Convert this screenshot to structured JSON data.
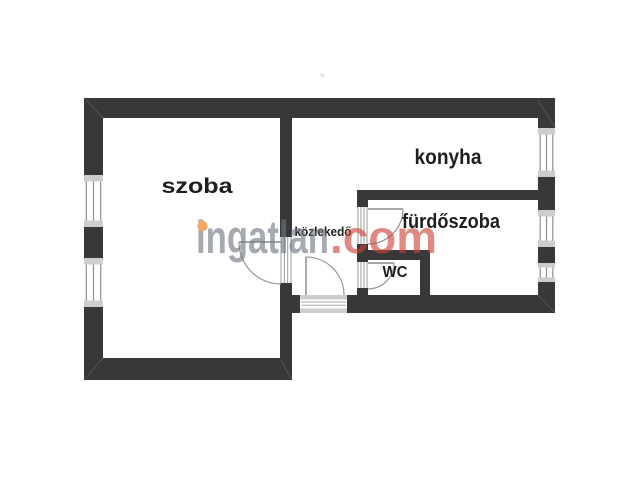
{
  "app": {
    "type": "floorplan",
    "background": "#ffffff"
  },
  "floorplan": {
    "rooms": [
      {
        "id": "szoba",
        "label": "szoba"
      },
      {
        "id": "konyha",
        "label": "konyha"
      },
      {
        "id": "furdoszoba",
        "label": "fürdőszoba"
      },
      {
        "id": "wc",
        "label": "WC"
      },
      {
        "id": "kozlekedo",
        "label": "közlekedő"
      }
    ],
    "wall_color": "#383838",
    "window_frame_color": "#cdcdcd",
    "symbol_line_color": "#8f8f8f",
    "label_color": "#1e1e1e"
  },
  "watermark": {
    "brand": "ingatlan",
    "suffix": ".com",
    "brand_color": "#a8abb0",
    "suffix_color": "#e18a80",
    "dot_color": "#f0a468"
  }
}
